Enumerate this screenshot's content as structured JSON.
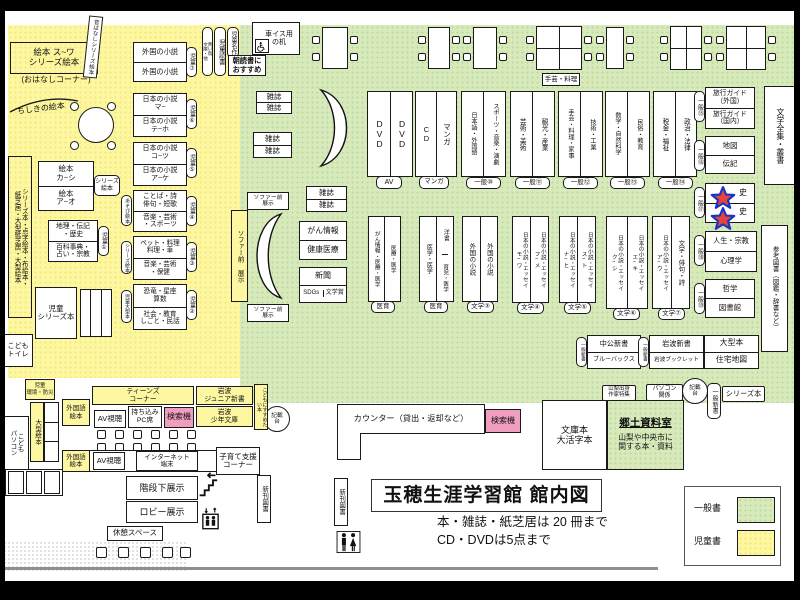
{
  "colors": {
    "children_area": "#fdf7a1",
    "general_area": "#d8eabc",
    "search_machine": "#f09ec0",
    "star_fill": "#e8423c",
    "star_stroke": "#1536c4"
  },
  "icons": {
    "wheelchair-icon": "wheelchair",
    "stairs-icon": "stairs",
    "elevator-icon": "elevator",
    "restroom-icon": "restroom",
    "star-marker-icon": "star"
  },
  "children": {
    "ehon_main": "絵本 ス~ワ\nシリーズ絵本",
    "ohanashi": "(おはなしコーナー)",
    "mukashi_strip": "昔ばなしシリーズ絵本",
    "chishiki": "ちしきの絵本",
    "left_strip": "シリーズ本・点字絵本・布絵本・\n紙芝居・大型紙芝居・大型絵本",
    "ehon_kashi": "絵本\nカ~シ",
    "ehon_ao": "絵本\nア~オ",
    "series_ehon_tag": "シリーズ\n絵本",
    "chiri": "地理・伝記\n・歴史",
    "hyakka": "百科事典・\n占い・宗教",
    "gaikoku_a": "外国の小説",
    "gaikoku_b": "外国の小説",
    "nihon_ma": "日本の小説\nマ~",
    "nihon_teho": "日本の小説\nテ~ホ",
    "nihon_kotsu": "日本の小説\nコ~ツ",
    "nihon_ake": "日本の小説\nア~ケ",
    "kotoba": "ことば・詩\n俳句・短歌",
    "ongaku_sports": "音楽・芸術\n・スポーツ",
    "pet": "ペット・料理\n料理・車",
    "ongaku_hoken": "音楽・芸術\n・保健",
    "kyoryu": "恐竜・星座\n算数",
    "shakai": "社会・教育\nしごと・民話",
    "tag_jido1": "児童①",
    "tag_jido2": "児童②",
    "tag_jido3": "児童③",
    "tag_jido4": "児童④",
    "tag_jido5": "児童⑤",
    "tag_jido6": "児童⑥",
    "tag_jido7": "児童⑦",
    "tag_asobi": "あそび絵本",
    "tag_series_ehon": "シリーズ絵本",
    "tag_jido_ogata": "児童大型本",
    "jido_series": "児童\nシリーズ本",
    "kodomo_toilet": "こども\nトイレ",
    "kankyo_bosai": "児童\n環境・防災",
    "aoitori": "青い鳥\n文庫・他",
    "jido_dokusho": "児童読書",
    "jido_meisaku": "児童名作",
    "asadoku": "朝読書に\nおすすめ",
    "ogata_ehon": "大型絵本",
    "kodomo_pc": "こども\nパソコン",
    "teens_corner": "ティーンズ\nコーナー",
    "gaikokugo_ehon": "外国語\n絵本",
    "av_shicho": "AV視聴",
    "mochikomi_pc": "持ち込み\nPC席",
    "kensakuki": "検索機",
    "iwanami_junior": "岩波\nジュニア新書",
    "iwanami_shonen": "岩波\n少年文庫",
    "susumetai": "こどもにすすめたい本",
    "internet_tanmatsu": "インターネット\n端末",
    "kosodate": "子育て支援\nコーナー"
  },
  "general": {
    "kurumaisu": "車イス用\nの机",
    "shugei_table": "手芸・料理",
    "zasshi": "雑誌",
    "dvd": "DVD",
    "cd": "CD",
    "manga": "マンガ",
    "tag_av": "AV",
    "tag_manga": "マンガ",
    "s10_l": "日本語・外国語",
    "s10_r": "スポーツ・音楽・演劇",
    "s11_l": "芸術・美術",
    "s11_r": "観光・産業",
    "s12_l": "手芸・料理・家事",
    "s12_r": "技術・工業",
    "s13_l": "数学・自然科学",
    "s13_r": "民俗・教育",
    "s14_l": "税金・福祉",
    "s14_r": "政治・法律",
    "tag10": "一般⑩",
    "tag11": "一般⑪",
    "tag12": "一般⑫",
    "tag13": "一般⑬",
    "tag14": "一般⑭",
    "tag15": "一般⑮",
    "tag16": "一般⑯",
    "tag17": "一般⑰",
    "tag18": "一般⑱",
    "tag19": "一般⑲",
    "ryoko_gaikoku": "旅行ガイド\n（外国）",
    "ryoko_kokunai": "旅行ガイド\n（国内）",
    "chizu": "地図",
    "denki": "伝記",
    "shi_1": "史",
    "shi_2": "史",
    "jinsei": "人生・宗教",
    "shinrigaku": "心理学",
    "tetsugaku": "哲学",
    "toshokan": "図書館",
    "bungaku_zenshu": "文学全集・叢書",
    "sanko_tosho": "参考図書（図鑑・辞書など）",
    "sofa_mae_v": "ソファー前 展示",
    "sofa_mae": "ソファー前\n展示",
    "gan_joho": "がん情報",
    "kenko_iryo": "健康医療",
    "shinbun": "新聞",
    "sdgs": "SDGs",
    "bungakusho": "文学賞",
    "med1_l": "がん情報・医療・医学",
    "med1_r": "医療・医学",
    "med2_l": "医学・医学",
    "yosho": "洋書",
    "ikuji": "育児・医学",
    "tag_iiku": "医育",
    "fgn_l": "外国の小説",
    "fgn_r": "外国の小説",
    "f4_l": "日本の小説・エッセイ\nモ~ワ",
    "f4_r": "日本の小説・エッセイ\nフ~メ",
    "f5_l": "日本の小説・エッセイ\nナ~ヒ",
    "f5_r": "日本の小説・エッセイ\nス~ト",
    "f6_l": "日本の小説・エッセイ\nク~シ",
    "f6_r": "日本の小説・エッセイ\nエ~キ",
    "f7_l": "日本の小説・エッセイ\nア~ウ",
    "f7_r": "文学・俳句・詩",
    "tagf3": "文学③",
    "tagf4": "文学④",
    "tagf5": "文学⑤",
    "tagf6": "文学⑥",
    "tagf7": "文学⑦",
    "chuko": "中公新書",
    "bluebacks": "ブルーバックス",
    "iwanami_shinsho": "岩波新書",
    "iwanami_booklet": "岩波ブックレット",
    "tag_ippan_shinsho": "一般新書",
    "ogata_bon": "大型本",
    "jutaku_chizu": "住宅地図",
    "yamanashi_tokushu": "山梨出身\n作家特集",
    "pasokon_kankei": "パソコン\n関係",
    "kisaidai": "記載\n台",
    "series_bon": "シリーズ本",
    "bunkobon": "文庫本\n大活字本",
    "kyodo_title": "郷土資料室",
    "kyodo_desc": "山梨や中央市に\n関する本・資料",
    "counter": "カウンター（貸出・返却など）"
  },
  "facility": {
    "kaidan_shita": "階段下展示",
    "lobby": "ロビー展示",
    "kyukei": "休憩スペース",
    "shinkan": "新刊図書"
  },
  "footer": {
    "title": "玉穂生涯学習館 館内図",
    "note1": "本・雑誌・紙芝居は 20 冊まで",
    "note2": "CD・DVDは5点まで"
  },
  "legend": {
    "general_label": "一般書",
    "children_label": "児童書"
  }
}
